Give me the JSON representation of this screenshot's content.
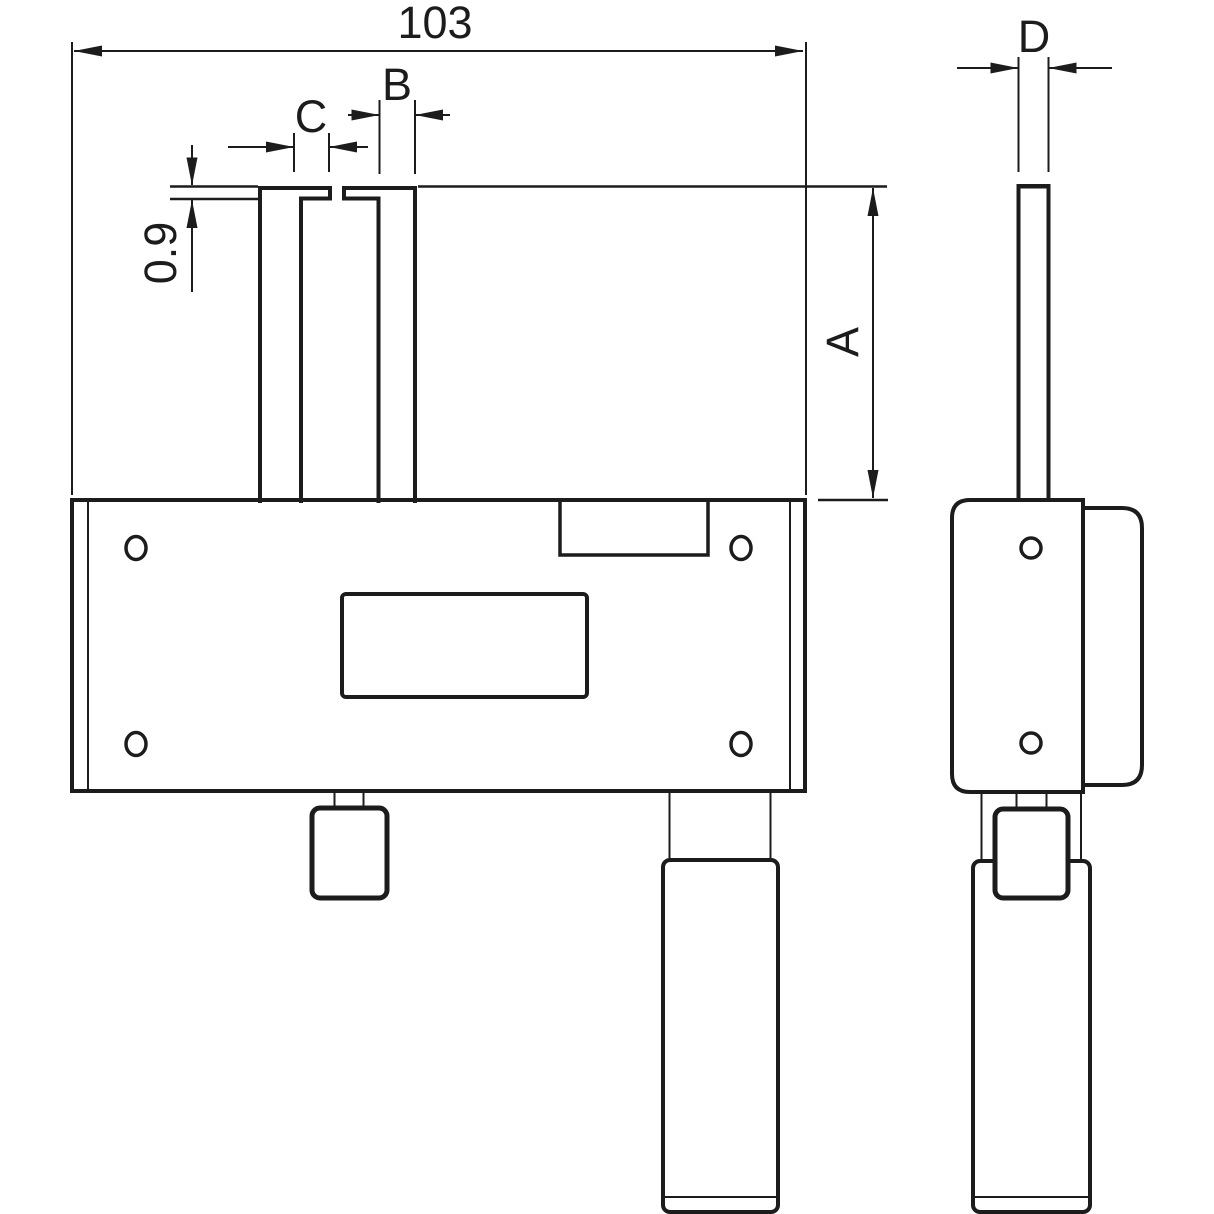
{
  "drawing": {
    "type": "technical-dimension-drawing",
    "views": {
      "front": "front-view",
      "side": "side-view"
    },
    "dimensions": {
      "overall_width": {
        "label": "103"
      },
      "tip_thickness": {
        "label": "0.9"
      },
      "blade_length": {
        "label": "A"
      },
      "blade_width": {
        "label": "B"
      },
      "tip_length": {
        "label": "C"
      },
      "blade_thickness": {
        "label": "D"
      }
    },
    "colors": {
      "line": "#1c1c1c",
      "background": "#ffffff"
    }
  }
}
